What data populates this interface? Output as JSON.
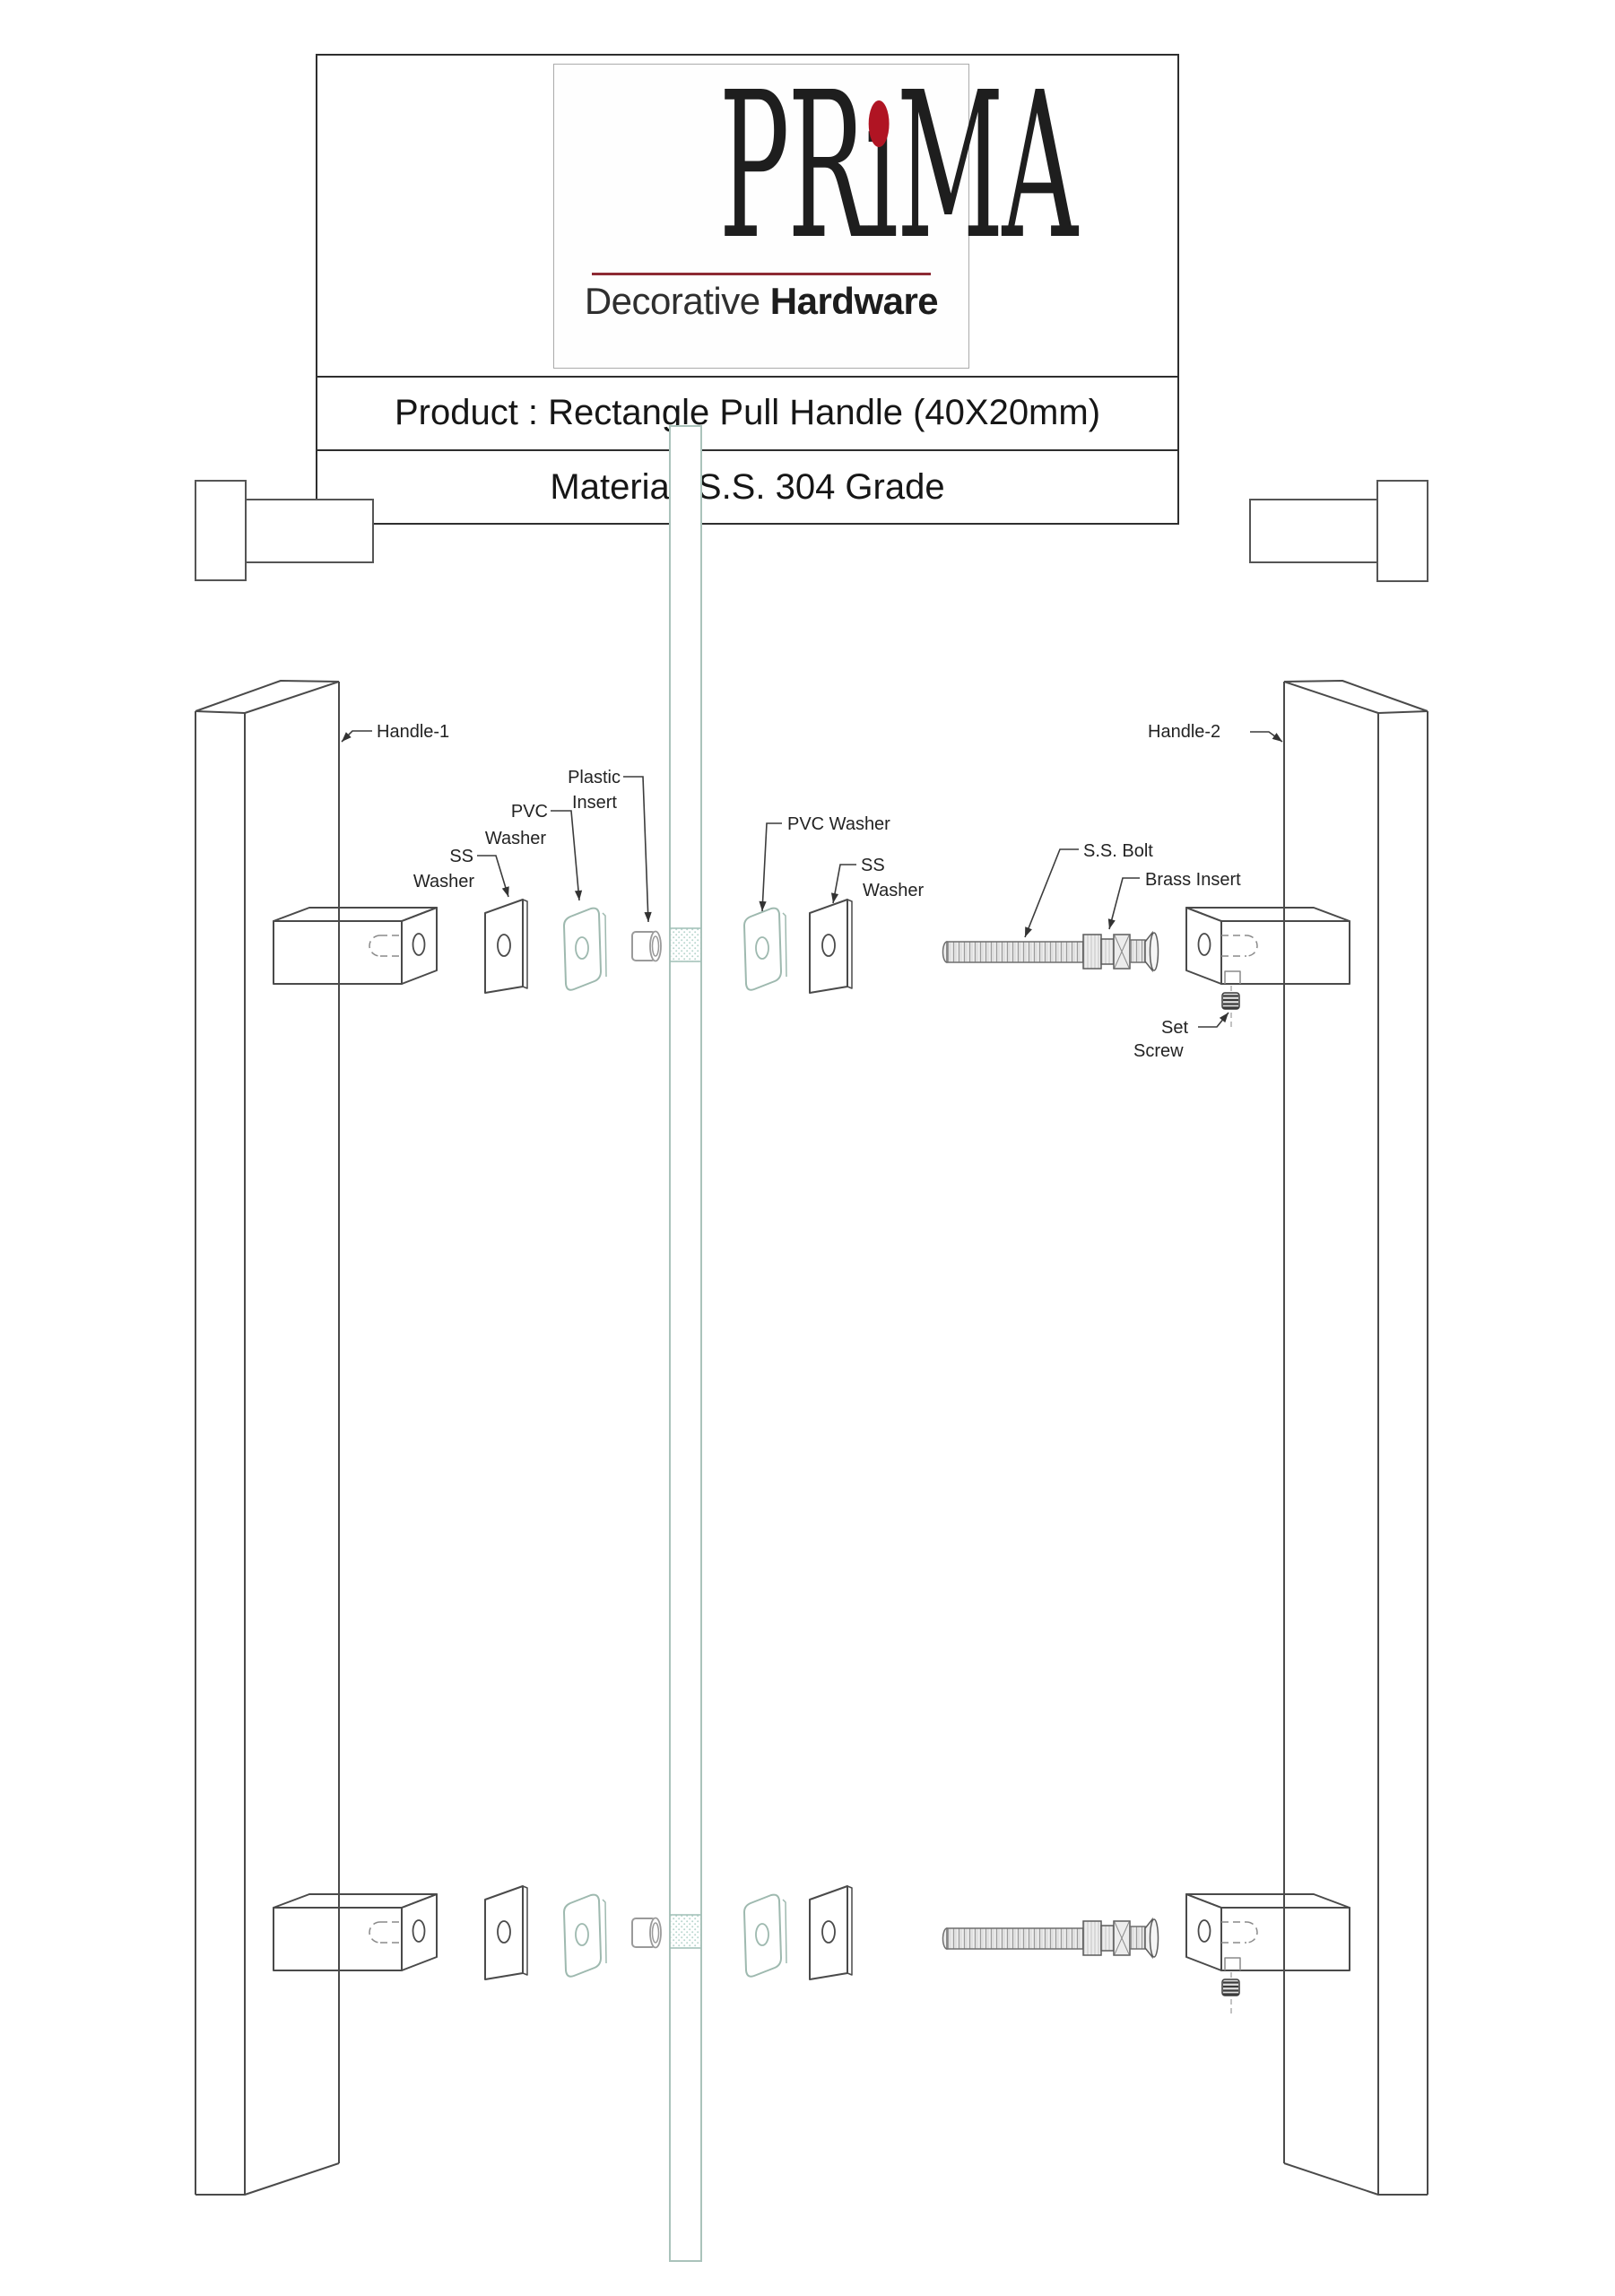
{
  "header": {
    "brand": {
      "part1": "PR",
      "part2": "ı",
      "part3": "MA",
      "tagline_regular": "Decorative ",
      "tagline_bold": "Hardware",
      "dot_color": "#b01423"
    },
    "product_label": "Product : Rectangle Pull Handle (40X20mm)",
    "material_label": "Material: S.S. 304 Grade"
  },
  "diagram": {
    "labels": {
      "handle1": "Handle-1",
      "handle2": "Handle-2",
      "plastic_insert_line1": "Plastic",
      "plastic_insert_line2": "Insert",
      "pvc_washer_left_line1": "PVC",
      "pvc_washer_left_line2": "Washer",
      "ss_washer_left_line1": "SS",
      "ss_washer_left_line2": "Washer",
      "pvc_washer_right": "PVC Washer",
      "ss_washer_right_line1": "SS",
      "ss_washer_right_line2": "Washer",
      "ss_bolt": "S.S. Bolt",
      "brass_insert": "Brass Insert",
      "set_screw_line1": "Set",
      "set_screw_line2": "Screw"
    },
    "colors": {
      "line": "#4a4a4a",
      "glass_edge": "#aac3bb",
      "glass_hatch": "#b9d6ce",
      "pvc_outline": "#9eb9af",
      "accent_red": "#b01423"
    }
  }
}
